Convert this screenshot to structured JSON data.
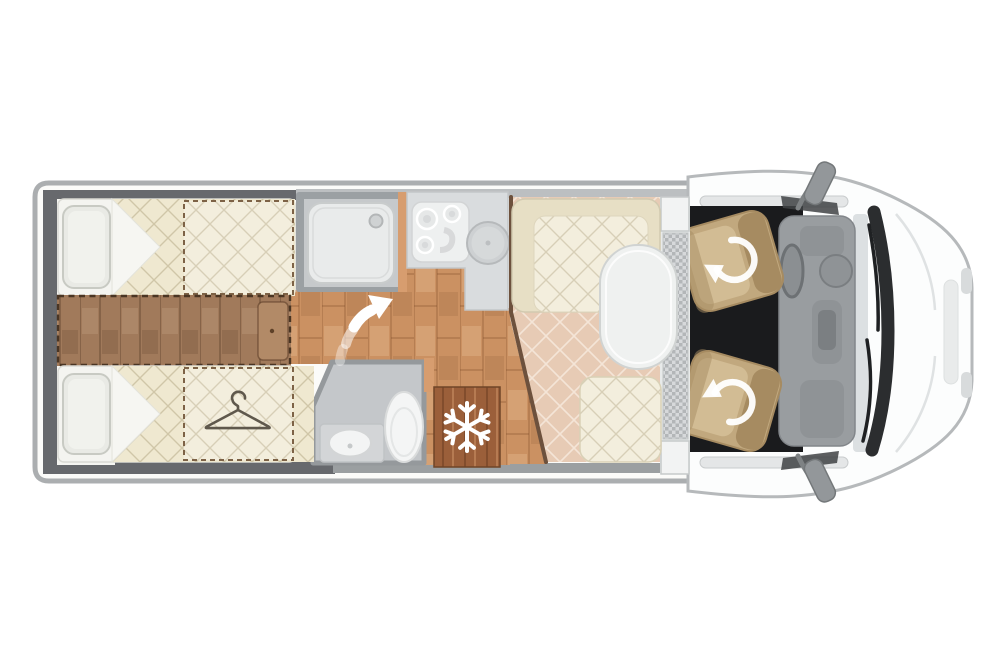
{
  "palette": {
    "page_bg": "#ffffff",
    "coach_body": "#fbfbf9",
    "coach_outline": "#abaeb0",
    "wall_dark": "#67696d",
    "wall_medium": "#9b9fa1",
    "wall_light_band": "#bcbfc1",
    "wood_floor": "#cb9162",
    "wood_dark": "#a17a5b",
    "fridge_wood": "#9b5f3a",
    "quilt_cream": "#efe8d0",
    "quilt_cream_light": "#f3eedd",
    "dinette_floor": "#e7cbb5",
    "bench_cream": "#e7dfc5",
    "mattress_white": "#f4f4f0",
    "pillow": "#e9eae5",
    "shower_wall": "#9ba0a3",
    "shower_floor": "#c6c9cb",
    "fixture_white": "#f4f5f5",
    "counter_gray": "#d9dcde",
    "bath_floor": "#c4c7ca",
    "wall_orange": "#d79d6f",
    "wall_wood_brown": "#6d513d",
    "cab_body": "#fcfdfd",
    "cab_outline": "#b6b9bb",
    "carpet_black": "#1a1b1d",
    "seat_tan": "#c1a87e",
    "seat_shade": "#a68b61",
    "seat_light": "#d2bc94",
    "dashboard_gray": "#999da0",
    "windshield_dark": "#2b2d2f",
    "glass_gray": "#dce0e2",
    "mirror_gray": "#93979a",
    "icon_white": "#ffffff",
    "hanger_stroke": "#5f584c",
    "table_white": "#eff1f0",
    "checker_bg": "#d7d9db"
  },
  "floorplan": {
    "view": "motorhome-top-view-cab-right",
    "zones": [
      {
        "name": "rear-bedroom",
        "features": [
          "twin-bed-top",
          "twin-bed-bottom",
          "pillows",
          "center-step-dashed",
          "overbed-dashed-area",
          "wardrobe-dashed-area"
        ]
      },
      {
        "name": "shower-room",
        "features": [
          "shower-tray",
          "drain"
        ]
      },
      {
        "name": "kitchen",
        "features": [
          "three-burner-hob",
          "round-sink",
          "worktop"
        ]
      },
      {
        "name": "washroom",
        "features": [
          "washbasin",
          "toilet"
        ]
      },
      {
        "name": "fridge",
        "features": [
          "snowflake-icon"
        ]
      },
      {
        "name": "dinette",
        "features": [
          "l-shaped-bench",
          "oval-table",
          "side-bench"
        ]
      },
      {
        "name": "entrance-step",
        "features": [
          "checker-tread"
        ]
      },
      {
        "name": "cab",
        "features": [
          "swivel-driver-seat",
          "swivel-passenger-seat",
          "dashboard",
          "steering-wheel",
          "windshield-wipers",
          "side-mirrors"
        ]
      }
    ],
    "icons": [
      "hanger-icon",
      "snowflake-icon",
      "swivel-arrow-icon",
      "entry-steps-arrow-icon"
    ]
  }
}
